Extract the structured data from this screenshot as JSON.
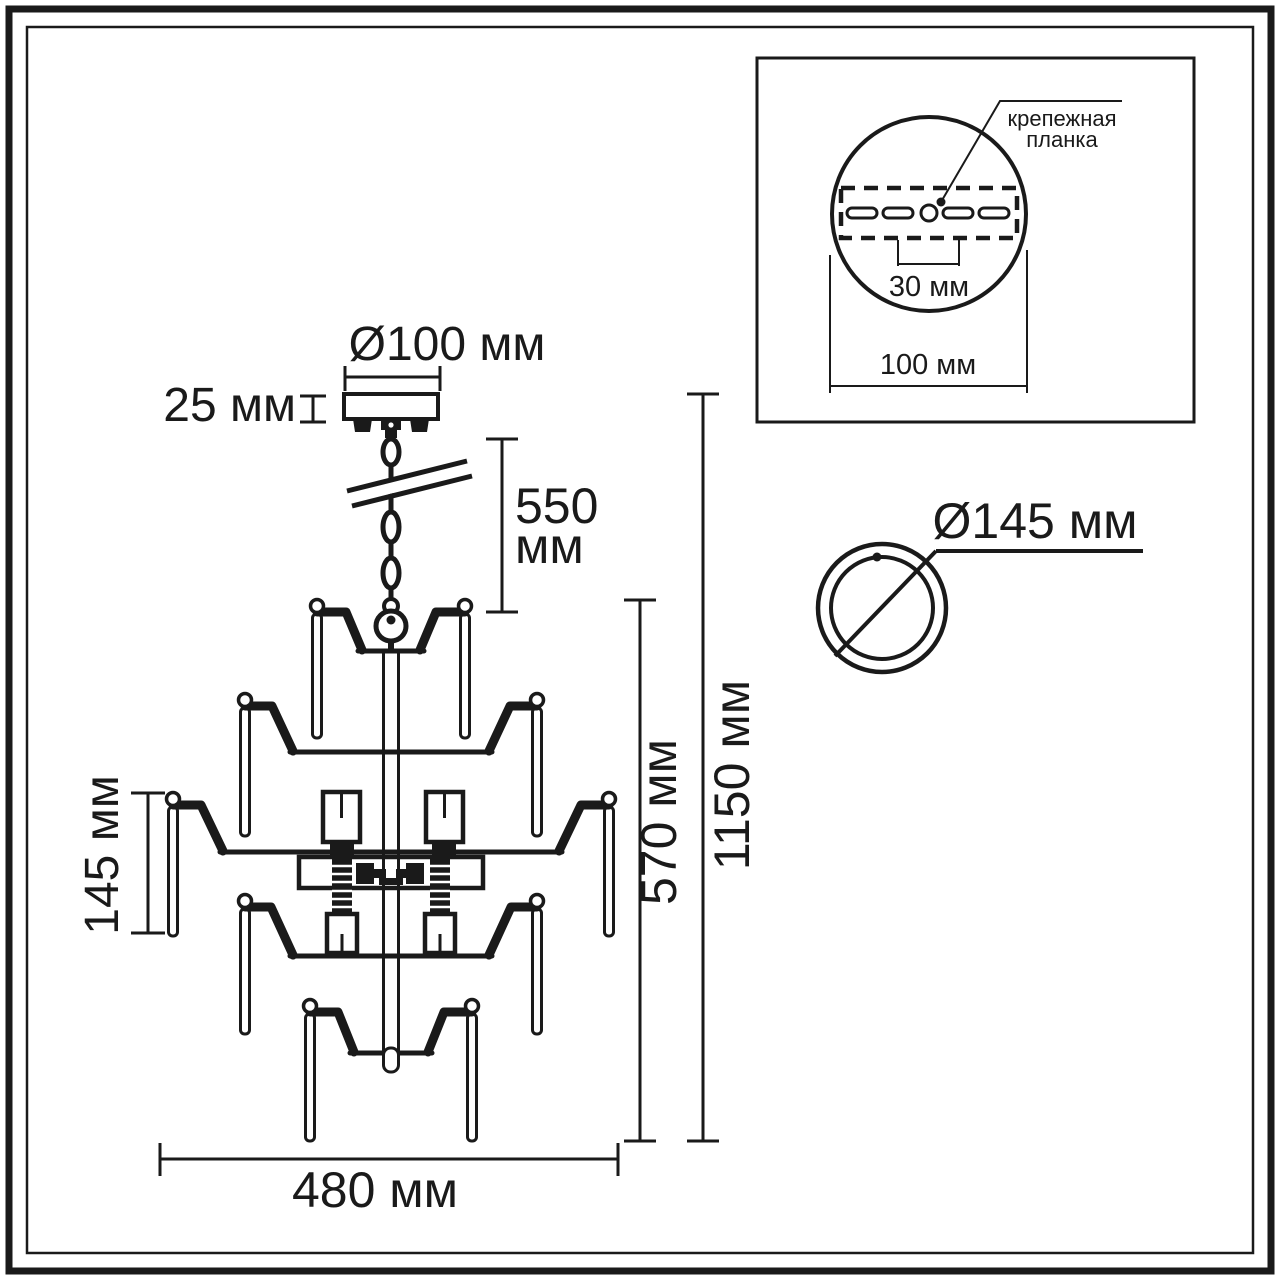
{
  "diagram": {
    "kind": "chandelier installation technical drawing",
    "colors": {
      "line": "#1a1a1a",
      "background": "#ffffff"
    },
    "chandelier": {
      "dim_canopy_diameter": "Ø100 мм",
      "dim_canopy_height": "25 мм",
      "dim_chain_length_line1": "550",
      "dim_chain_length_line2": "мм",
      "dim_pendant_length": "145 мм",
      "dim_body_height": "570 мм",
      "dim_total_height": "1150 мм",
      "dim_width": "480 мм"
    },
    "mount_detail": {
      "callout_line1": "крепежная",
      "callout_line2": "планка",
      "dim_slot_spacing": "30 мм",
      "dim_plate_width": "100 мм"
    },
    "cup_detail": {
      "dim_diameter": "Ø145 мм"
    }
  }
}
